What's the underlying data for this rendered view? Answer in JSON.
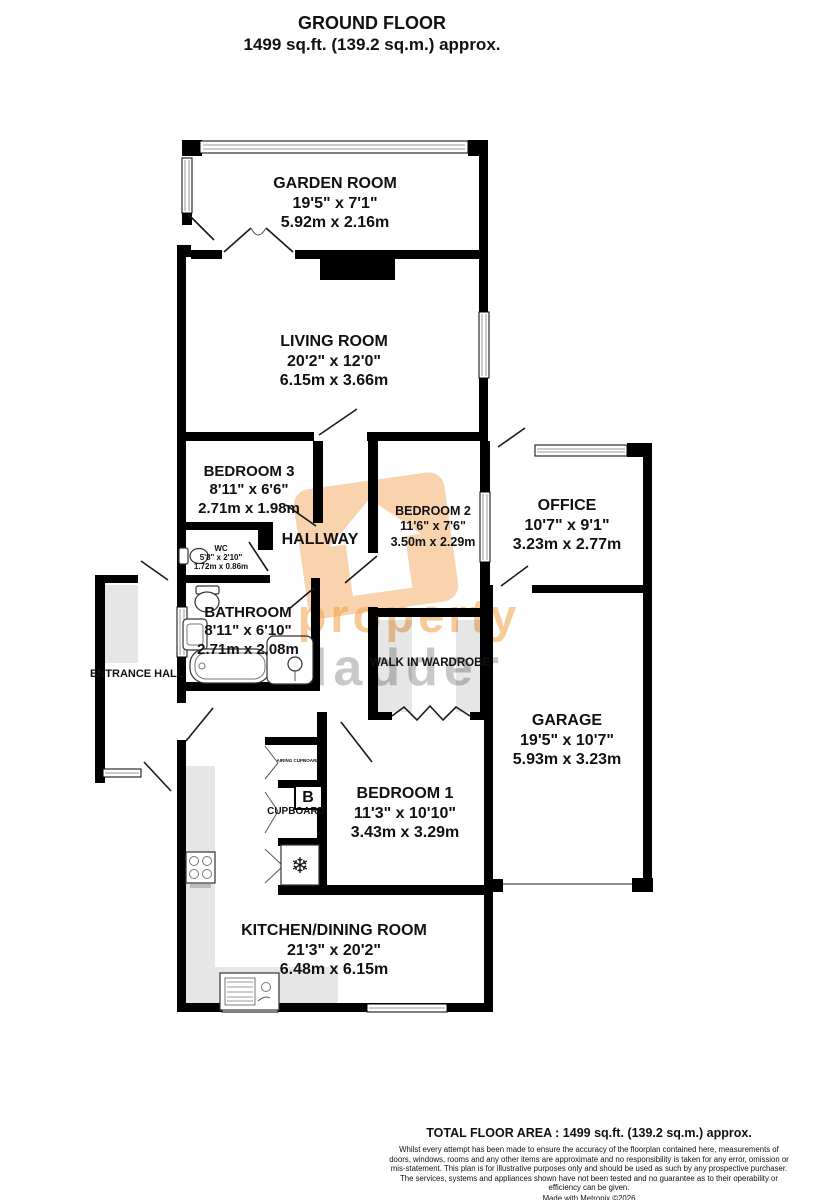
{
  "title": {
    "line1": "GROUND FLOOR",
    "line2": "1499 sq.ft. (139.2 sq.m.) approx."
  },
  "watermark": {
    "word1": "property",
    "word2": "ladder",
    "orange": "#f09e42",
    "gray": "#7d7d7d"
  },
  "colors": {
    "wall": "#000000",
    "shade": "#e6e6e6",
    "wmOrange": "rgba(240,158,66,0.55)",
    "wmGray": "rgba(125,125,125,0.42)"
  },
  "rooms": {
    "garden": {
      "name": "GARDEN ROOM",
      "imperial": "19'5\"  x 7'1\"",
      "metric": "5.92m  x 2.16m"
    },
    "living": {
      "name": "LIVING ROOM",
      "imperial": "20'2\"  x 12'0\"",
      "metric": "6.15m  x 3.66m"
    },
    "bedroom3": {
      "name": "BEDROOM 3",
      "imperial": "8'11\"  x 6'6\"",
      "metric": "2.71m  x 1.98m"
    },
    "hallway": {
      "name": "HALLWAY"
    },
    "bedroom2": {
      "name": "BEDROOM 2",
      "imperial": "11'6\"  x 7'6\"",
      "metric": "3.50m  x 2.29m"
    },
    "office": {
      "name": "OFFICE",
      "imperial": "10'7\"  x 9'1\"",
      "metric": "3.23m  x 2.77m"
    },
    "wc": {
      "name": "WC",
      "imperial": "5'8\" x 2'10\"",
      "metric": "1.72m  x 0.86m"
    },
    "bathroom": {
      "name": "BATHROOM",
      "imperial": "8'11\"  x 6'10\"",
      "metric": "2.71m  x 2.08m"
    },
    "entrance": {
      "name": "ENTRANCE HALL"
    },
    "wardrobe": {
      "name": "WALK IN WARDROBE"
    },
    "garage": {
      "name": "GARAGE",
      "imperial": "19'5\"  x 10'7\"",
      "metric": "5.93m  x 3.23m"
    },
    "bedroom1": {
      "name": "BEDROOM 1",
      "imperial": "11'3\"  x 10'10\"",
      "metric": "3.43m  x 3.29m"
    },
    "kitchen": {
      "name": "KITCHEN/DINING ROOM",
      "imperial": "21'3\"  x 20'2\"",
      "metric": "6.48m  x 6.15m"
    },
    "airing": {
      "name": "AIRING CUPBOARD"
    },
    "cupboard": {
      "name": "CUPBOARD",
      "symbol": "B"
    }
  },
  "icons": {
    "freezer": "❄"
  },
  "footer": {
    "total": "TOTAL FLOOR AREA : 1499 sq.ft. (139.2 sq.m.) approx.",
    "disclaimer": "Whilst every attempt has been made to ensure the accuracy of the floorplan contained here, measurements of doors, windows, rooms and any other items are approximate and no responsibility is taken for any error, omission or mis-statement. This plan is for illustrative purposes only and should be used as such by any prospective purchaser. The services, systems and appliances shown have not been tested and no guarantee as to their operability or efficiency can be given.",
    "credit": "Made with Metropix ©2026"
  }
}
